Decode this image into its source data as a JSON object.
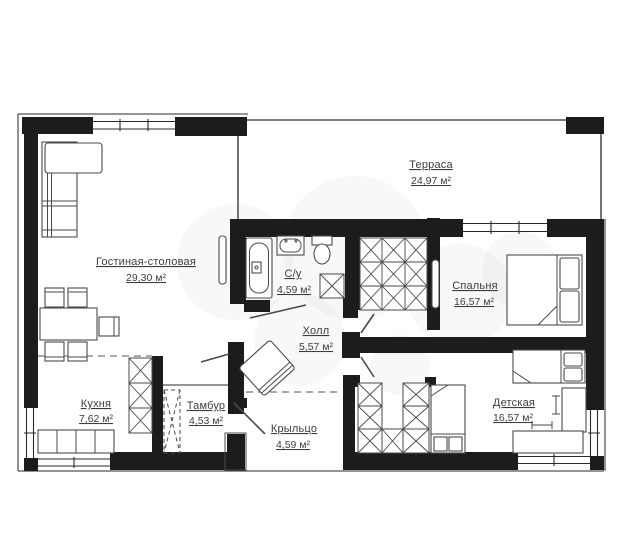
{
  "plan": {
    "title": "floor-plan",
    "rooms": [
      {
        "id": "living",
        "name": "Гостиная-столовая",
        "area": "29,30 м²"
      },
      {
        "id": "terrace",
        "name": "Терраса",
        "area": "24,97 м²"
      },
      {
        "id": "bathroom",
        "name": "С/у",
        "area": "4,59 м²"
      },
      {
        "id": "bedroom",
        "name": "Спальня",
        "area": "16,57 м²"
      },
      {
        "id": "hall",
        "name": "Холл",
        "area": "5,57 м²"
      },
      {
        "id": "kitchen",
        "name": "Кухня",
        "area": "7,62 м²"
      },
      {
        "id": "vestibule",
        "name": "Тамбур",
        "area": "4,53 м²"
      },
      {
        "id": "porch",
        "name": "Крыльцо",
        "area": "4,59 м²"
      },
      {
        "id": "children",
        "name": "Детская",
        "area": "16,57 м²"
      }
    ],
    "colors": {
      "wall": "#1c1c1c",
      "furniture_stroke": "#4a4a4a",
      "label_text": "#3d3d3d",
      "background": "#ffffff",
      "watermark": "#777777"
    }
  }
}
